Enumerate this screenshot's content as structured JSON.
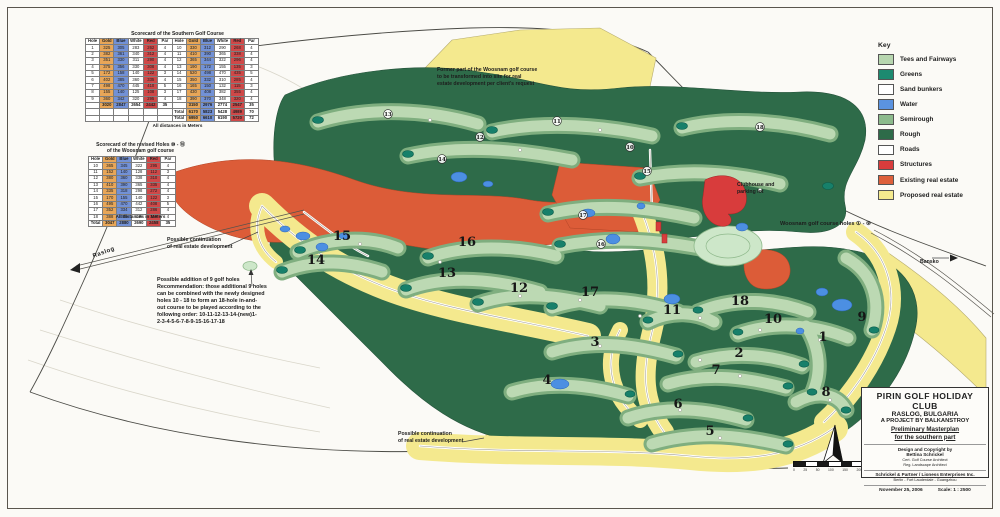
{
  "legend": {
    "title": "Key",
    "items": [
      {
        "label": "Tees and Fairways",
        "color": "#b7d6af"
      },
      {
        "label": "Greens",
        "color": "#1d8a70"
      },
      {
        "label": "Sand bunkers",
        "color": "#ffffff"
      },
      {
        "label": "Water",
        "color": "#5b93e0"
      },
      {
        "label": "Semirough",
        "color": "#8cba8c"
      },
      {
        "label": "Rough",
        "color": "#2e6b49"
      },
      {
        "label": "Roads",
        "color": "#ffffff"
      },
      {
        "label": "Structures",
        "color": "#d83c3c"
      },
      {
        "label": "Existing real estate",
        "color": "#dd5f3a"
      },
      {
        "label": "Proposed real estate",
        "color": "#f4e98e"
      }
    ]
  },
  "scorecard_south": {
    "caption": "Scorecard of the Southern Golf Course",
    "footnote": "All distances in Meters",
    "columns": [
      "Hole",
      "Gold",
      "Blue",
      "White",
      "Red",
      "Par",
      "Hole",
      "Gold",
      "Blue",
      "White",
      "Red",
      "Par"
    ],
    "rows": [
      [
        "1",
        "325",
        "305",
        "283",
        "262",
        "4",
        "10",
        "330",
        "312",
        "290",
        "268",
        "4"
      ],
      [
        "2",
        "382",
        "361",
        "340",
        "312",
        "4",
        "11",
        "410",
        "390",
        "365",
        "338",
        "4"
      ],
      [
        "3",
        "351",
        "330",
        "311",
        "290",
        "4",
        "12",
        "365",
        "344",
        "322",
        "296",
        "4"
      ],
      [
        "4",
        "375",
        "356",
        "330",
        "308",
        "4",
        "13",
        "190",
        "172",
        "155",
        "135",
        "3"
      ],
      [
        "5",
        "172",
        "158",
        "140",
        "122",
        "3",
        "14",
        "520",
        "498",
        "470",
        "435",
        "5"
      ],
      [
        "6",
        "402",
        "385",
        "360",
        "335",
        "4",
        "15",
        "350",
        "332",
        "310",
        "285",
        "4"
      ],
      [
        "7",
        "498",
        "470",
        "445",
        "410",
        "5",
        "16",
        "165",
        "150",
        "132",
        "115",
        "3"
      ],
      [
        "8",
        "155",
        "140",
        "125",
        "108",
        "3",
        "17",
        "430",
        "408",
        "382",
        "355",
        "4"
      ],
      [
        "9",
        "360",
        "342",
        "320",
        "295",
        "4",
        "18",
        "390",
        "370",
        "348",
        "320",
        "4"
      ],
      [
        "",
        "3020",
        "2847",
        "2654",
        "2442",
        "35",
        "",
        "3150",
        "2976",
        "2774",
        "2547",
        "35"
      ],
      [
        "",
        "",
        "",
        "",
        "",
        "",
        "Total",
        "6170",
        "5823",
        "5428",
        "4989",
        "70"
      ],
      [
        "",
        "",
        "",
        "",
        "",
        "",
        "Total",
        "6950",
        "6610",
        "6190",
        "5720",
        "72"
      ]
    ]
  },
  "scorecard_woosnam": {
    "caption_line1": "Scorecard of the revised Holes ⑩ - ⑱",
    "caption_line2": "of the Woosnam golf course",
    "footnote": "All distances in Meters",
    "columns": [
      "Hole",
      "Gold",
      "Blue",
      "White",
      "Red",
      "Par"
    ],
    "rows": [
      [
        "10",
        "365",
        "345",
        "322",
        "295",
        "4"
      ],
      [
        "11",
        "152",
        "140",
        "128",
        "112",
        "3"
      ],
      [
        "12",
        "380",
        "360",
        "338",
        "310",
        "4"
      ],
      [
        "13",
        "410",
        "390",
        "365",
        "335",
        "4"
      ],
      [
        "14",
        "335",
        "318",
        "298",
        "272",
        "4"
      ],
      [
        "15",
        "170",
        "155",
        "140",
        "122",
        "3"
      ],
      [
        "16",
        "495",
        "470",
        "442",
        "408",
        "5"
      ],
      [
        "17",
        "352",
        "334",
        "312",
        "286",
        "4"
      ],
      [
        "18",
        "388",
        "368",
        "345",
        "318",
        "4"
      ],
      [
        "Total",
        "3047",
        "2880",
        "2690",
        "2458",
        "35"
      ]
    ]
  },
  "annotations": {
    "former_woosnam": "Former part of the Woosnam golf course\nto be transformed into site for real\nestate development per client's request",
    "clubhouse": "Clubhouse and\nparking lot",
    "woosnam_holes": "Woosnam golf course holes ① - ⑨",
    "continuation_nw": "Possible continuation\nof real estate development",
    "continuation_s": "Possible continuation\nof real estate development",
    "addition": "Possible addition of 9 golf holes\nRecommendation: those additional 9 holes\ncan be combined with the newly designed\nholes 10 - 18 to form an 18-hole in-and-\nout course to be played according to the\nfollowing order: 10-11-12-13-14-(new)1-\n2-3-4-5-6-7-8-9-15-16-17-18",
    "raslog": "Raslog",
    "bansko": "Bansko"
  },
  "title_block": {
    "line1": "PIRIN GOLF HOLIDAY CLUB",
    "line2": "RASLOG, BULGARIA",
    "line3": "A PROJECT BY BALKANSTROY",
    "sub1": "Preliminary Masterplan",
    "sub2": "for the southern part",
    "design1": "Design and Copyright by",
    "design2": "Bettina Schrickel",
    "design3": "Cert. Golf Course Architect",
    "design4": "Reg. Landscape Architect",
    "firm1": "Schrickel & Partner / Lioness Enterprises Inc.",
    "firm2": "Berlin - Fort Lauderdale - Guangzhou",
    "date": "November 25, 2006",
    "scale": "Scale: 1 : 2500"
  },
  "map": {
    "hole_numbers": [
      {
        "n": "15",
        "x": 342,
        "y": 240
      },
      {
        "n": "14",
        "x": 316,
        "y": 264
      },
      {
        "n": "16",
        "x": 467,
        "y": 246
      },
      {
        "n": "13",
        "x": 447,
        "y": 277
      },
      {
        "n": "12",
        "x": 519,
        "y": 292
      },
      {
        "n": "17",
        "x": 590,
        "y": 296
      },
      {
        "n": "11",
        "x": 672,
        "y": 314
      },
      {
        "n": "18",
        "x": 740,
        "y": 305
      },
      {
        "n": "10",
        "x": 773,
        "y": 323
      },
      {
        "n": "9",
        "x": 862,
        "y": 321
      },
      {
        "n": "1",
        "x": 823,
        "y": 341
      },
      {
        "n": "2",
        "x": 739,
        "y": 357
      },
      {
        "n": "7",
        "x": 716,
        "y": 374
      },
      {
        "n": "3",
        "x": 595,
        "y": 346
      },
      {
        "n": "4",
        "x": 547,
        "y": 384
      },
      {
        "n": "8",
        "x": 826,
        "y": 396
      },
      {
        "n": "6",
        "x": 678,
        "y": 408
      },
      {
        "n": "5",
        "x": 710,
        "y": 435
      }
    ],
    "circled_numbers": [
      {
        "n": "13",
        "x": 388,
        "y": 116
      },
      {
        "n": "12",
        "x": 480,
        "y": 139
      },
      {
        "n": "11",
        "x": 557,
        "y": 123
      },
      {
        "n": "14",
        "x": 442,
        "y": 161
      },
      {
        "n": "10",
        "x": 630,
        "y": 149
      },
      {
        "n": "15",
        "x": 647,
        "y": 173
      },
      {
        "n": "17",
        "x": 583,
        "y": 217
      },
      {
        "n": "16",
        "x": 601,
        "y": 246
      },
      {
        "n": "18",
        "x": 760,
        "y": 129
      }
    ],
    "scale_bar_labels": [
      "0",
      "25",
      "50",
      "100",
      "150",
      "200m"
    ]
  }
}
